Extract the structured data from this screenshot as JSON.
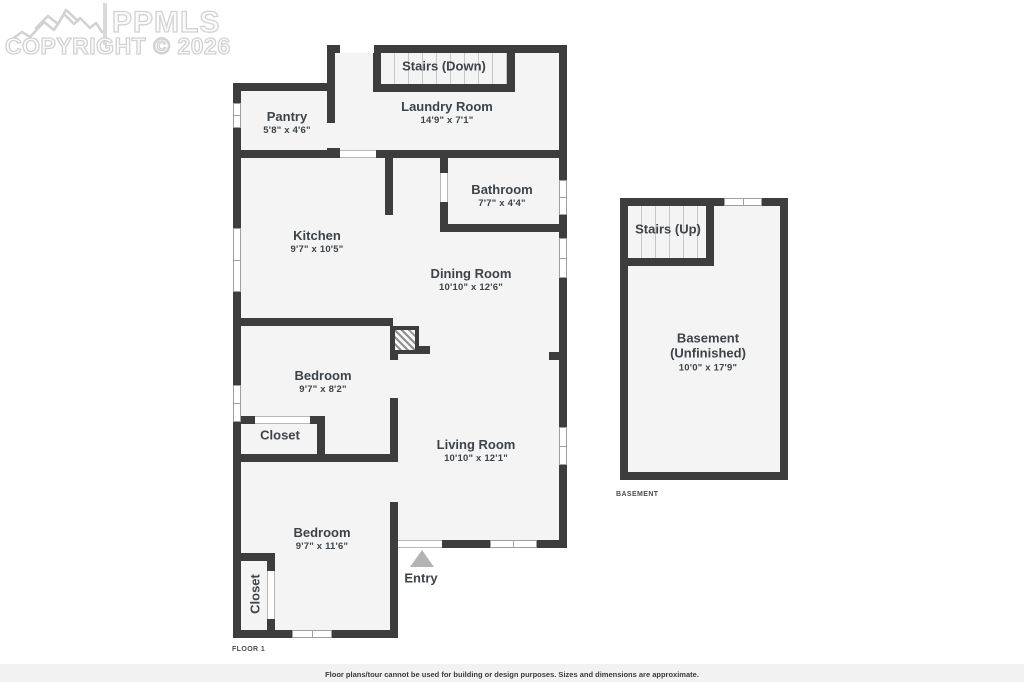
{
  "watermark": {
    "brand": "PPMLS",
    "copyright": "COPYRIGHT © 2026"
  },
  "rooms": {
    "stairs_down": {
      "name": "Stairs (Down)"
    },
    "laundry": {
      "name": "Laundry Room",
      "dims": "14'9\" x 7'1\""
    },
    "pantry": {
      "name": "Pantry",
      "dims": "5'8\" x 4'6\""
    },
    "kitchen": {
      "name": "Kitchen",
      "dims": "9'7\" x 10'5\""
    },
    "bathroom": {
      "name": "Bathroom",
      "dims": "7'7\" x 4'4\""
    },
    "dining": {
      "name": "Dining Room",
      "dims": "10'10\" x 12'6\""
    },
    "bedroom1": {
      "name": "Bedroom",
      "dims": "9'7\" x 8'2\""
    },
    "closet1": {
      "name": "Closet"
    },
    "living": {
      "name": "Living Room",
      "dims": "10'10\" x 12'1\""
    },
    "bedroom2": {
      "name": "Bedroom",
      "dims": "9'7\" x 11'6\""
    },
    "closet2": {
      "name": "Closet"
    },
    "entry": {
      "name": "Entry"
    },
    "stairs_up": {
      "name": "Stairs (Up)"
    },
    "basement": {
      "name": "Basement",
      "name2": "(Unfinished)",
      "dims": "10'0\" x 17'9\""
    }
  },
  "plan_tags": {
    "floor1": "FLOOR 1",
    "basement": "BASEMENT"
  },
  "footer": {
    "disclaimer": "Floor plans/tour cannot be used for building or design purposes. Sizes and dimensions are approximate."
  },
  "colors": {
    "wall": "#3d3d3d",
    "room_fill": "#f4f4f4",
    "text": "#3e4347",
    "watermark_outline": "#d2d2d2",
    "entry_arrow": "#b3b3b3"
  }
}
